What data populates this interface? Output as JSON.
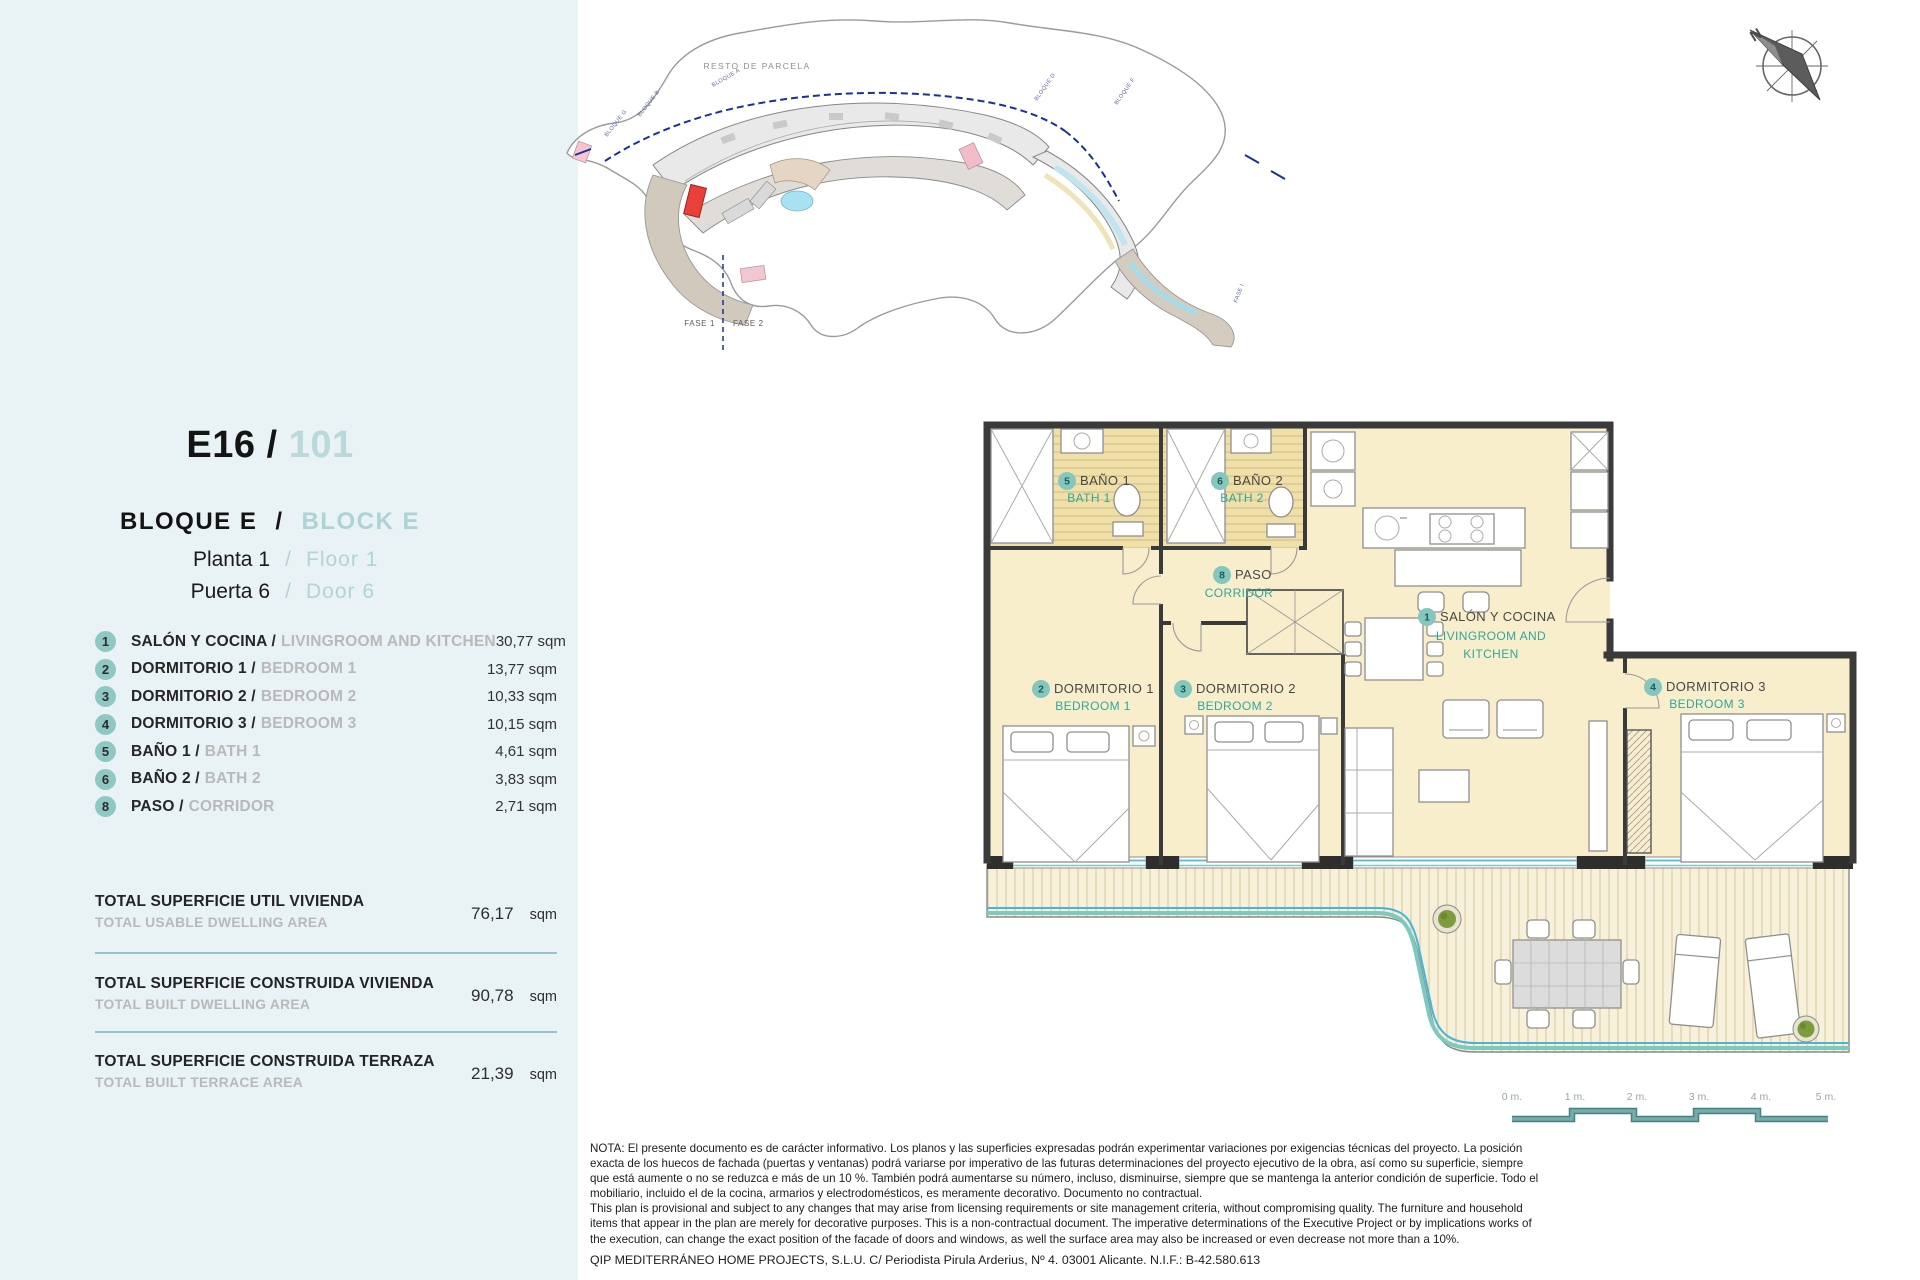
{
  "header": {
    "code": "E16 /",
    "number": "101",
    "block_es": "BLOQUE  E",
    "block_sep": "/",
    "block_en": "BLOCK  E",
    "floor_es": "Planta 1",
    "floor_sep": "/",
    "floor_en": "Floor  1",
    "door_es": "Puerta 6",
    "door_sep": "/",
    "door_en": "Door  6"
  },
  "rooms": [
    {
      "num": "1",
      "es": "SALÓN Y COCINA /",
      "en": "LIVINGROOM AND KITCHEN",
      "area": "30,77 sqm"
    },
    {
      "num": "2",
      "es": "DORMITORIO 1 /",
      "en": "BEDROOM 1",
      "area": "13,77 sqm"
    },
    {
      "num": "3",
      "es": "DORMITORIO 2 /",
      "en": "BEDROOM 2",
      "area": "10,33 sqm"
    },
    {
      "num": "4",
      "es": "DORMITORIO 3 /",
      "en": "BEDROOM 3",
      "area": "10,15 sqm"
    },
    {
      "num": "5",
      "es": "BAÑO 1 /",
      "en": "BATH 1",
      "area": "4,61 sqm"
    },
    {
      "num": "6",
      "es": "BAÑO 2 /",
      "en": "BATH 2",
      "area": "3,83 sqm"
    },
    {
      "num": "8",
      "es": "PASO /",
      "en": "CORRIDOR",
      "area": "2,71 sqm"
    }
  ],
  "totals": [
    {
      "es": "TOTAL SUPERFICIE UTIL VIVIENDA",
      "en": "TOTAL USABLE DWELLING AREA",
      "value": "76,17",
      "unit": "sqm"
    },
    {
      "es": "TOTAL SUPERFICIE CONSTRUIDA VIVIENDA",
      "en": "TOTAL BUILT DWELLING AREA",
      "value": "90,78",
      "unit": "sqm"
    },
    {
      "es": "TOTAL SUPERFICIE CONSTRUIDA TERRAZA",
      "en": "TOTAL BUILT TERRACE AREA",
      "value": "21,39",
      "unit": "sqm"
    }
  ],
  "site_plan": {
    "resto_de_parcela": "RESTO DE PARCELA",
    "fase_1": "FASE 1",
    "fase_2": "FASE 2",
    "bloque_a": "BLOQUE A",
    "bloque_b": "BLOQUE B",
    "bloque_g": "BLOQUE G",
    "bloque_d": "BLOQUE D",
    "bloque_f": "BLOQUE F",
    "fase_i": "FASE I"
  },
  "floor_plan": {
    "salon": {
      "num": "1",
      "es": "SALÓN Y COCINA",
      "en1": "LIVINGROOM AND",
      "en2": "KITCHEN"
    },
    "dorm1": {
      "num": "2",
      "es": "DORMITORIO 1",
      "en": "BEDROOM 1"
    },
    "dorm2": {
      "num": "3",
      "es": "DORMITORIO 2",
      "en": "BEDROOM 2"
    },
    "dorm3": {
      "num": "4",
      "es": "DORMITORIO 3",
      "en": "BEDROOM 3"
    },
    "bath1": {
      "num": "5",
      "es": "BAÑO 1",
      "en": "BATH 1"
    },
    "bath2": {
      "num": "6",
      "es": "BAÑO 2",
      "en": "BATH 2"
    },
    "paso": {
      "num": "8",
      "es": "PASO",
      "en": "CORRIDOR"
    }
  },
  "compass": {
    "north": "N"
  },
  "scale_bar": {
    "labels": [
      "0 m.",
      "1 m.",
      "2 m.",
      "3 m.",
      "4 m.",
      "5 m."
    ]
  },
  "note": {
    "es": "NOTA: El presente documento es de carácter informativo. Los planos y las superficies expresadas podrán experimentar variaciones por exigencias técnicas del proyecto. La posición exacta de los huecos de fachada (puertas y ventanas) podrá variarse por imperativo de las futuras determinaciones del proyecto ejecutivo de la obra, así como su superficie, siempre que está aumente o no se reduzca e más de un 10 %. También podrá aumentarse su número, incluso, disminuirse, siempre que se mantenga la anterior condición de superficie. Todo el mobiliario, incluido el de la cocina, armarios y electrodomésticos, es meramente decorativo. Documento no contractual.",
    "en": "This plan is provisional and subject to any changes that may arise from licensing requirements or site management criteria, without compromising quality. The furniture and household items that appear in the plan are merely for decorative purposes. This is a non-contractual document. The imperative determinations of the Executive Project or by implications works of the execution, can change the exact position of the facade of doors and windows, as well the surface area may also be increased or even decrease not more than a 10%.",
    "company": "QIP MEDITERRÁNEO HOME PROJECTS, S.L.U. C/ Periodista Pirula Arderius, Nº 4. 03001 Alicante. N.I.F.: B-42.580.613"
  },
  "colors": {
    "panel_bg": "#e9f2f4",
    "accent_teal": "#2fa79e",
    "light_teal": "#aed3d5",
    "floor_cream": "#f8eecb",
    "bath_tan": "#efdfa9",
    "wall": "#3a3a3a",
    "red_unit": "#e8413a",
    "water_blue": "#45b5da"
  }
}
